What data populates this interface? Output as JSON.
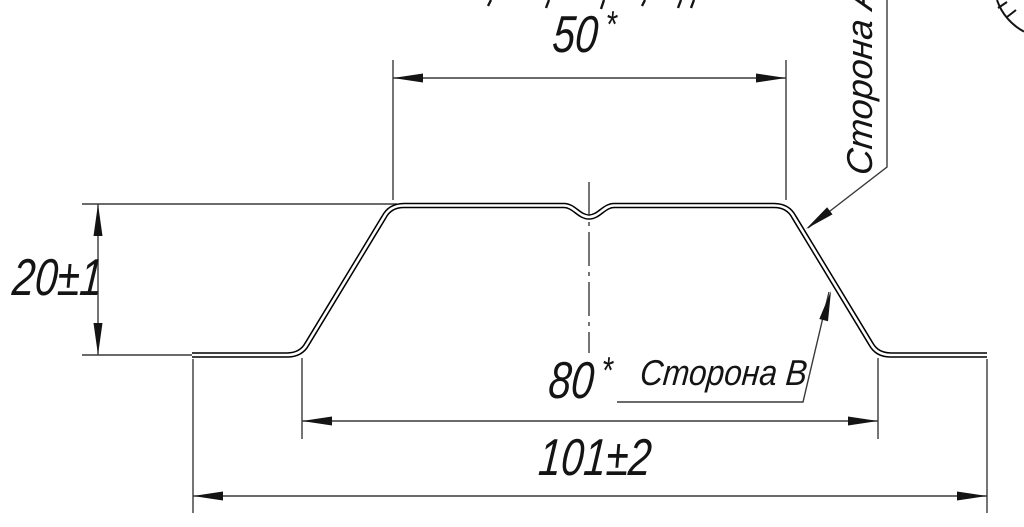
{
  "drawing": {
    "type": "profile-cross-section",
    "dimensions": {
      "top_width": "50",
      "top_width_star": "*",
      "height": "20±1",
      "inner_width": "80",
      "inner_width_star": "*",
      "overall_width": "101±2"
    },
    "labels": {
      "side_a": "Сторона А",
      "side_b": "Сторона В"
    },
    "colors": {
      "background": "#ffffff",
      "profile_line": "#000000",
      "thin_line": "#3a3a3a",
      "text": "#141414"
    }
  }
}
